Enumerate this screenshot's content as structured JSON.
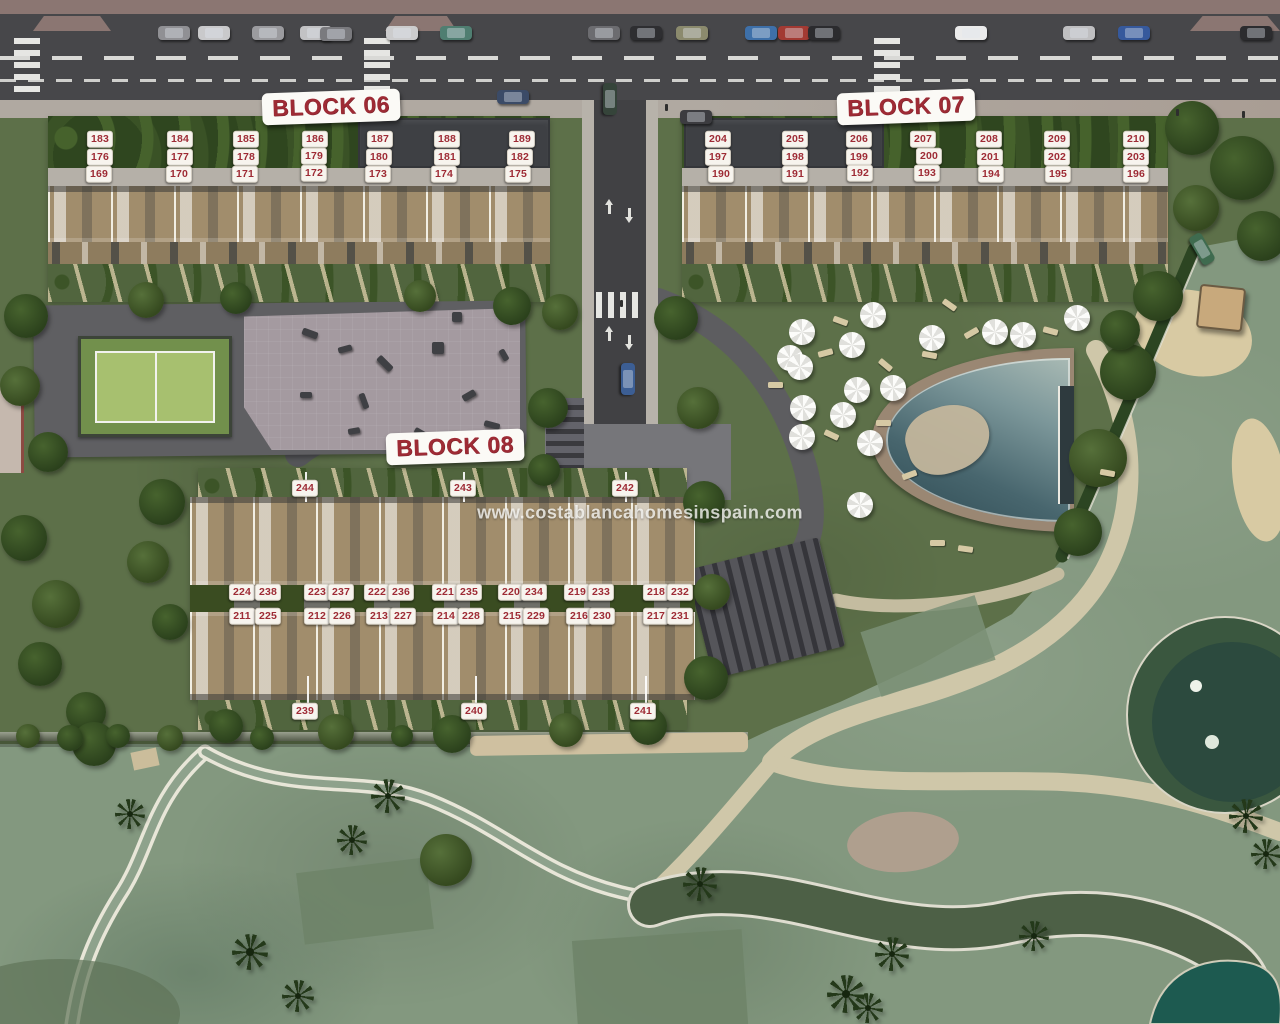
{
  "watermark": {
    "text": "www.costablancahomesinspain.com"
  },
  "blocks": [
    {
      "id": "block-06",
      "title": "BLOCK 06",
      "x": 331,
      "y": 107
    },
    {
      "id": "block-07",
      "title": "BLOCK 07",
      "x": 906,
      "y": 107
    },
    {
      "id": "block-08",
      "title": "BLOCK 08",
      "x": 455,
      "y": 447
    }
  ],
  "unit_chips": [
    {
      "label": "183",
      "x": 100,
      "y": 139
    },
    {
      "label": "184",
      "x": 180,
      "y": 139
    },
    {
      "label": "185",
      "x": 246,
      "y": 139
    },
    {
      "label": "186",
      "x": 315,
      "y": 139
    },
    {
      "label": "187",
      "x": 380,
      "y": 139
    },
    {
      "label": "188",
      "x": 447,
      "y": 139
    },
    {
      "label": "189",
      "x": 522,
      "y": 139
    },
    {
      "label": "176",
      "x": 100,
      "y": 157
    },
    {
      "label": "177",
      "x": 180,
      "y": 157
    },
    {
      "label": "178",
      "x": 246,
      "y": 157
    },
    {
      "label": "179",
      "x": 314,
      "y": 156
    },
    {
      "label": "180",
      "x": 379,
      "y": 157
    },
    {
      "label": "181",
      "x": 447,
      "y": 157
    },
    {
      "label": "182",
      "x": 520,
      "y": 157
    },
    {
      "label": "169",
      "x": 99,
      "y": 174
    },
    {
      "label": "170",
      "x": 179,
      "y": 174
    },
    {
      "label": "171",
      "x": 245,
      "y": 174
    },
    {
      "label": "172",
      "x": 314,
      "y": 173
    },
    {
      "label": "173",
      "x": 378,
      "y": 174
    },
    {
      "label": "174",
      "x": 444,
      "y": 174
    },
    {
      "label": "175",
      "x": 518,
      "y": 174
    },
    {
      "label": "204",
      "x": 718,
      "y": 139
    },
    {
      "label": "205",
      "x": 795,
      "y": 139
    },
    {
      "label": "206",
      "x": 859,
      "y": 139
    },
    {
      "label": "207",
      "x": 923,
      "y": 139
    },
    {
      "label": "208",
      "x": 989,
      "y": 139
    },
    {
      "label": "209",
      "x": 1057,
      "y": 139
    },
    {
      "label": "210",
      "x": 1136,
      "y": 139
    },
    {
      "label": "197",
      "x": 718,
      "y": 157
    },
    {
      "label": "198",
      "x": 795,
      "y": 157
    },
    {
      "label": "199",
      "x": 859,
      "y": 157
    },
    {
      "label": "200",
      "x": 929,
      "y": 156
    },
    {
      "label": "201",
      "x": 990,
      "y": 157
    },
    {
      "label": "202",
      "x": 1057,
      "y": 157
    },
    {
      "label": "203",
      "x": 1136,
      "y": 157
    },
    {
      "label": "190",
      "x": 721,
      "y": 174
    },
    {
      "label": "191",
      "x": 795,
      "y": 174
    },
    {
      "label": "192",
      "x": 860,
      "y": 173
    },
    {
      "label": "193",
      "x": 927,
      "y": 173
    },
    {
      "label": "194",
      "x": 991,
      "y": 174
    },
    {
      "label": "195",
      "x": 1058,
      "y": 174
    },
    {
      "label": "196",
      "x": 1136,
      "y": 174
    },
    {
      "label": "244",
      "x": 305,
      "y": 488
    },
    {
      "label": "243",
      "x": 463,
      "y": 488
    },
    {
      "label": "242",
      "x": 625,
      "y": 488
    },
    {
      "label": "224",
      "x": 242,
      "y": 592
    },
    {
      "label": "238",
      "x": 268,
      "y": 592
    },
    {
      "label": "223",
      "x": 317,
      "y": 592
    },
    {
      "label": "237",
      "x": 341,
      "y": 592
    },
    {
      "label": "222",
      "x": 377,
      "y": 592
    },
    {
      "label": "236",
      "x": 401,
      "y": 592
    },
    {
      "label": "221",
      "x": 445,
      "y": 592
    },
    {
      "label": "235",
      "x": 469,
      "y": 592
    },
    {
      "label": "220",
      "x": 511,
      "y": 592
    },
    {
      "label": "234",
      "x": 534,
      "y": 592
    },
    {
      "label": "219",
      "x": 577,
      "y": 592
    },
    {
      "label": "233",
      "x": 601,
      "y": 592
    },
    {
      "label": "218",
      "x": 656,
      "y": 592
    },
    {
      "label": "232",
      "x": 680,
      "y": 592
    },
    {
      "label": "211",
      "x": 242,
      "y": 616
    },
    {
      "label": "225",
      "x": 268,
      "y": 616
    },
    {
      "label": "212",
      "x": 317,
      "y": 616
    },
    {
      "label": "226",
      "x": 342,
      "y": 616
    },
    {
      "label": "213",
      "x": 379,
      "y": 616
    },
    {
      "label": "227",
      "x": 403,
      "y": 616
    },
    {
      "label": "214",
      "x": 446,
      "y": 616
    },
    {
      "label": "228",
      "x": 471,
      "y": 616
    },
    {
      "label": "215",
      "x": 512,
      "y": 616
    },
    {
      "label": "229",
      "x": 536,
      "y": 616
    },
    {
      "label": "216",
      "x": 579,
      "y": 616
    },
    {
      "label": "230",
      "x": 602,
      "y": 616
    },
    {
      "label": "217",
      "x": 656,
      "y": 616
    },
    {
      "label": "231",
      "x": 680,
      "y": 616
    },
    {
      "label": "239",
      "x": 305,
      "y": 711
    },
    {
      "label": "240",
      "x": 474,
      "y": 711
    },
    {
      "label": "241",
      "x": 643,
      "y": 711
    }
  ],
  "leader_lines": [
    {
      "x": 305,
      "y": 472,
      "h": 30
    },
    {
      "x": 463,
      "y": 472,
      "h": 30
    },
    {
      "x": 625,
      "y": 472,
      "h": 30
    },
    {
      "x": 307,
      "y": 676,
      "h": 28
    },
    {
      "x": 475,
      "y": 676,
      "h": 28
    },
    {
      "x": 645,
      "y": 676,
      "h": 28
    }
  ],
  "colors": {
    "label_red": "#9e2b35",
    "chip_bg": "#f7f4ee",
    "road": "#47474a",
    "resort_lawn": "#5d7049",
    "golf_green": "#83987f",
    "roof_tan": "#a18d6c",
    "pool_water": "#48666e",
    "path_beige": "#cfc7a9"
  },
  "scene": {
    "umbrellas": [
      {
        "x": 873,
        "y": 315
      },
      {
        "x": 802,
        "y": 332
      },
      {
        "x": 1077,
        "y": 318
      },
      {
        "x": 995,
        "y": 332
      },
      {
        "x": 1023,
        "y": 335
      },
      {
        "x": 932,
        "y": 338
      },
      {
        "x": 852,
        "y": 345
      },
      {
        "x": 790,
        "y": 358
      },
      {
        "x": 800,
        "y": 367
      },
      {
        "x": 857,
        "y": 390
      },
      {
        "x": 893,
        "y": 388
      },
      {
        "x": 803,
        "y": 408
      },
      {
        "x": 843,
        "y": 415
      },
      {
        "x": 802,
        "y": 437
      },
      {
        "x": 870,
        "y": 443
      },
      {
        "x": 860,
        "y": 505
      }
    ],
    "loungers": [
      {
        "x": 833,
        "y": 318,
        "r": 20
      },
      {
        "x": 818,
        "y": 350,
        "r": -15
      },
      {
        "x": 878,
        "y": 362,
        "r": 40
      },
      {
        "x": 922,
        "y": 352,
        "r": 10
      },
      {
        "x": 964,
        "y": 330,
        "r": -30
      },
      {
        "x": 1043,
        "y": 328,
        "r": 15
      },
      {
        "x": 876,
        "y": 420,
        "r": 0
      },
      {
        "x": 824,
        "y": 432,
        "r": 25
      },
      {
        "x": 902,
        "y": 472,
        "r": -20
      },
      {
        "x": 942,
        "y": 302,
        "r": 35
      },
      {
        "x": 768,
        "y": 382,
        "r": 0
      },
      {
        "x": 1100,
        "y": 470,
        "r": 10
      },
      {
        "x": 930,
        "y": 540,
        "r": 0
      },
      {
        "x": 958,
        "y": 546,
        "r": 8
      }
    ],
    "cars": [
      {
        "x": 158,
        "y": 26,
        "c": "#909094",
        "r": 0
      },
      {
        "x": 198,
        "y": 26,
        "c": "#c9c9cb",
        "r": 0
      },
      {
        "x": 252,
        "y": 26,
        "c": "#9b9b9f",
        "r": 0
      },
      {
        "x": 300,
        "y": 26,
        "c": "#c2c2c4",
        "r": 0
      },
      {
        "x": 320,
        "y": 27,
        "c": "#7a7a7e",
        "r": 0
      },
      {
        "x": 386,
        "y": 26,
        "c": "#cccccd",
        "r": 0
      },
      {
        "x": 440,
        "y": 26,
        "c": "#4f7e71",
        "r": 0
      },
      {
        "x": 588,
        "y": 26,
        "c": "#6c6c70",
        "r": 0
      },
      {
        "x": 630,
        "y": 26,
        "c": "#2e2e31",
        "r": 0
      },
      {
        "x": 676,
        "y": 26,
        "c": "#8b8a6d",
        "r": 0
      },
      {
        "x": 745,
        "y": 26,
        "c": "#3e70a9",
        "r": 0
      },
      {
        "x": 778,
        "y": 26,
        "c": "#a33a33",
        "r": 0
      },
      {
        "x": 808,
        "y": 26,
        "c": "#2b2b2e",
        "r": 0
      },
      {
        "x": 955,
        "y": 26,
        "c": "#ebebeb",
        "r": 0
      },
      {
        "x": 1063,
        "y": 26,
        "c": "#bfbfc1",
        "r": 0
      },
      {
        "x": 1118,
        "y": 26,
        "c": "#36599c",
        "r": 0
      },
      {
        "x": 1240,
        "y": 26,
        "c": "#2c2c2f",
        "r": 0
      },
      {
        "x": 497,
        "y": 90,
        "c": "#3b4b67",
        "r": 0
      },
      {
        "x": 594,
        "y": 92,
        "c": "#35443a",
        "r": 90
      },
      {
        "x": 680,
        "y": 110,
        "c": "#3c3c40",
        "r": 0
      },
      {
        "x": 612,
        "y": 372,
        "c": "#3c5e94",
        "r": 90
      },
      {
        "x": 1186,
        "y": 242,
        "c": "#3f6b4f",
        "r": 60
      }
    ],
    "trees": [
      {
        "x": 1192,
        "y": 128,
        "s": 54,
        "t": 0
      },
      {
        "x": 1242,
        "y": 168,
        "s": 64,
        "t": 0
      },
      {
        "x": 1196,
        "y": 208,
        "s": 46,
        "t": 1
      },
      {
        "x": 1262,
        "y": 236,
        "s": 50,
        "t": 0
      },
      {
        "x": 1158,
        "y": 296,
        "s": 50,
        "t": 0
      },
      {
        "x": 1128,
        "y": 372,
        "s": 56,
        "t": 0
      },
      {
        "x": 1098,
        "y": 458,
        "s": 58,
        "t": 1
      },
      {
        "x": 1078,
        "y": 532,
        "s": 48,
        "t": 0
      },
      {
        "x": 560,
        "y": 312,
        "s": 36,
        "t": 1
      },
      {
        "x": 548,
        "y": 408,
        "s": 40,
        "t": 0
      },
      {
        "x": 676,
        "y": 318,
        "s": 44,
        "t": 0
      },
      {
        "x": 698,
        "y": 408,
        "s": 42,
        "t": 1
      },
      {
        "x": 544,
        "y": 470,
        "s": 32,
        "t": 0
      },
      {
        "x": 26,
        "y": 316,
        "s": 44,
        "t": 0
      },
      {
        "x": 20,
        "y": 386,
        "s": 40,
        "t": 1
      },
      {
        "x": 48,
        "y": 452,
        "s": 40,
        "t": 0
      },
      {
        "x": 24,
        "y": 538,
        "s": 46,
        "t": 0
      },
      {
        "x": 56,
        "y": 604,
        "s": 48,
        "t": 1
      },
      {
        "x": 40,
        "y": 664,
        "s": 44,
        "t": 0
      },
      {
        "x": 86,
        "y": 712,
        "s": 40,
        "t": 0
      },
      {
        "x": 146,
        "y": 300,
        "s": 36,
        "t": 1
      },
      {
        "x": 236,
        "y": 298,
        "s": 32,
        "t": 0
      },
      {
        "x": 420,
        "y": 296,
        "s": 32,
        "t": 1
      },
      {
        "x": 512,
        "y": 306,
        "s": 38,
        "t": 0
      },
      {
        "x": 162,
        "y": 502,
        "s": 46,
        "t": 0
      },
      {
        "x": 148,
        "y": 562,
        "s": 42,
        "t": 1
      },
      {
        "x": 170,
        "y": 622,
        "s": 36,
        "t": 0
      },
      {
        "x": 704,
        "y": 502,
        "s": 42,
        "t": 0
      },
      {
        "x": 712,
        "y": 592,
        "s": 36,
        "t": 1
      },
      {
        "x": 706,
        "y": 678,
        "s": 44,
        "t": 0
      },
      {
        "x": 226,
        "y": 726,
        "s": 34,
        "t": 0
      },
      {
        "x": 336,
        "y": 732,
        "s": 36,
        "t": 1
      },
      {
        "x": 452,
        "y": 734,
        "s": 38,
        "t": 0
      },
      {
        "x": 566,
        "y": 730,
        "s": 34,
        "t": 1
      },
      {
        "x": 648,
        "y": 726,
        "s": 38,
        "t": 0
      },
      {
        "x": 94,
        "y": 744,
        "s": 44,
        "t": 0
      },
      {
        "x": 28,
        "y": 736,
        "s": 24,
        "t": 1
      },
      {
        "x": 70,
        "y": 738,
        "s": 26,
        "t": 0
      },
      {
        "x": 118,
        "y": 736,
        "s": 24,
        "t": 0
      },
      {
        "x": 170,
        "y": 738,
        "s": 26,
        "t": 1
      },
      {
        "x": 262,
        "y": 738,
        "s": 24,
        "t": 0
      },
      {
        "x": 402,
        "y": 736,
        "s": 22,
        "t": 0
      },
      {
        "x": 446,
        "y": 860,
        "s": 52,
        "t": 1
      },
      {
        "x": 1120,
        "y": 330,
        "s": 40,
        "t": 0
      }
    ],
    "palms": [
      {
        "x": 388,
        "y": 796,
        "s": 34
      },
      {
        "x": 352,
        "y": 840,
        "s": 30
      },
      {
        "x": 250,
        "y": 952,
        "s": 36
      },
      {
        "x": 298,
        "y": 996,
        "s": 32
      },
      {
        "x": 846,
        "y": 994,
        "s": 38
      },
      {
        "x": 892,
        "y": 954,
        "s": 34
      },
      {
        "x": 1034,
        "y": 936,
        "s": 30
      },
      {
        "x": 1246,
        "y": 816,
        "s": 34
      },
      {
        "x": 1266,
        "y": 854,
        "s": 30
      },
      {
        "x": 700,
        "y": 884,
        "s": 34
      },
      {
        "x": 130,
        "y": 814,
        "s": 30
      },
      {
        "x": 868,
        "y": 1008,
        "s": 30
      }
    ],
    "play_items": [
      {
        "x": 302,
        "y": 330,
        "w": 16,
        "h": 7,
        "r": 20
      },
      {
        "x": 338,
        "y": 346,
        "w": 14,
        "h": 6,
        "r": -15
      },
      {
        "x": 376,
        "y": 360,
        "w": 18,
        "h": 7,
        "r": 45
      },
      {
        "x": 300,
        "y": 392,
        "w": 12,
        "h": 6,
        "r": 0
      },
      {
        "x": 356,
        "y": 398,
        "w": 16,
        "h": 6,
        "r": 70
      },
      {
        "x": 432,
        "y": 342,
        "w": 12,
        "h": 12,
        "r": 0
      },
      {
        "x": 462,
        "y": 392,
        "w": 14,
        "h": 7,
        "r": -30
      },
      {
        "x": 484,
        "y": 422,
        "w": 16,
        "h": 6,
        "r": 15
      },
      {
        "x": 348,
        "y": 428,
        "w": 12,
        "h": 6,
        "r": -10
      },
      {
        "x": 414,
        "y": 430,
        "w": 14,
        "h": 6,
        "r": 30
      },
      {
        "x": 452,
        "y": 312,
        "w": 10,
        "h": 10,
        "r": 0
      },
      {
        "x": 498,
        "y": 352,
        "w": 12,
        "h": 6,
        "r": 60
      }
    ],
    "people": [
      {
        "x": 665,
        "y": 104
      },
      {
        "x": 1176,
        "y": 109
      },
      {
        "x": 1242,
        "y": 111
      },
      {
        "x": 320,
        "y": 93
      },
      {
        "x": 900,
        "y": 95
      },
      {
        "x": 620,
        "y": 300
      }
    ]
  }
}
